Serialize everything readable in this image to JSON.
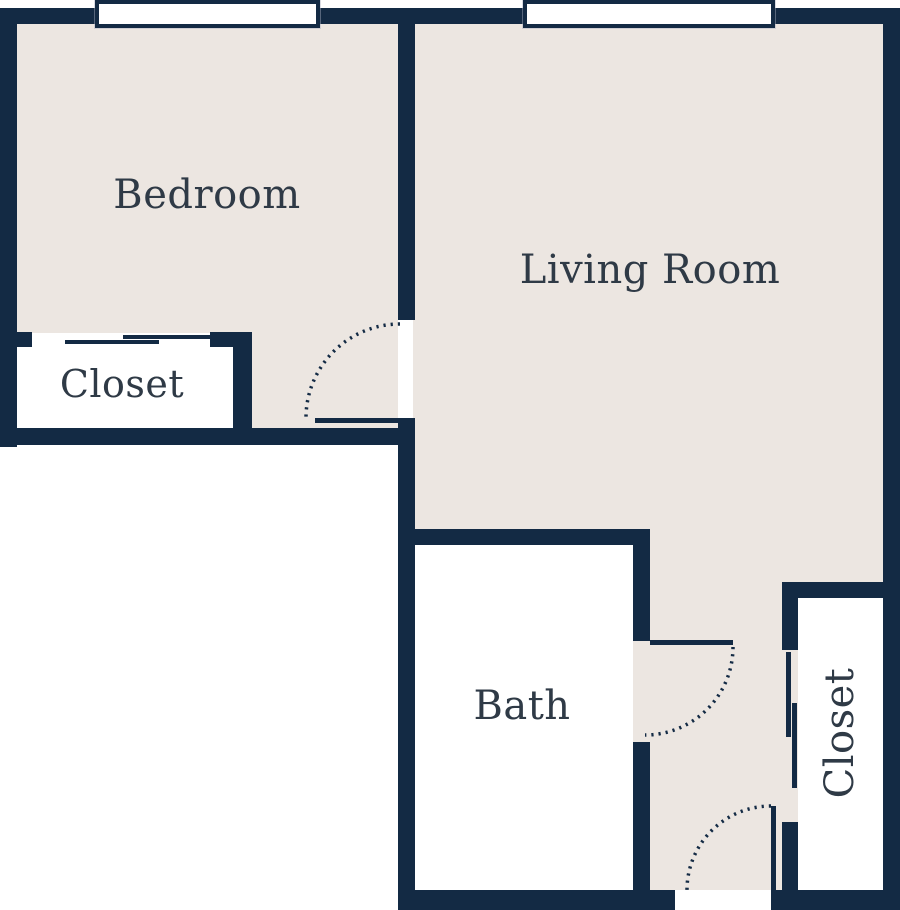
{
  "colors": {
    "wall": "#132A44",
    "floor": "#ECE6E1",
    "interior": "#FFFFFF",
    "background": "#FFFFFF",
    "label": "#2F3A46"
  },
  "rooms": {
    "bedroom": {
      "label": "Bedroom"
    },
    "living_room": {
      "label": "Living Room"
    },
    "bedroom_closet": {
      "label": "Closet"
    },
    "bath": {
      "label": "Bath"
    },
    "entry_closet": {
      "label": "Closet"
    }
  }
}
